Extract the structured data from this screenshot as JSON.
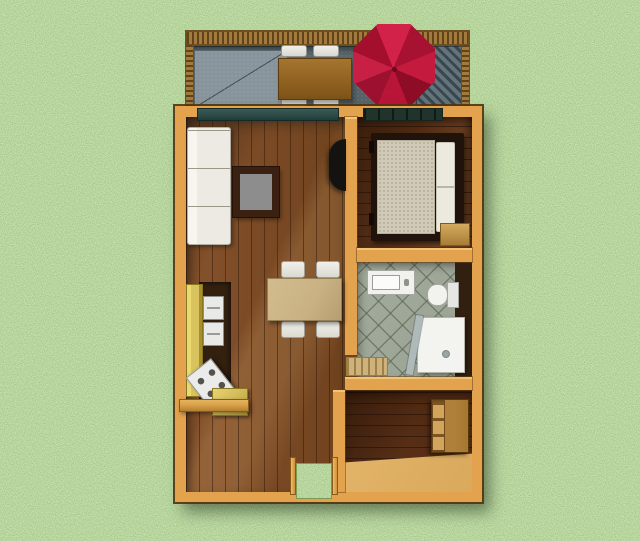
{
  "scene": {
    "type": "3d-floor-plan-render",
    "view": "top-down",
    "width_px": 640,
    "height_px": 541
  },
  "colors": {
    "grass": "#78a95e",
    "wall": "#e2a24e",
    "wall-highlight": "#f4c475",
    "wall-edge": "#7a5014",
    "living-floor": "#7b4a27",
    "bedroom-floor": "#5a3018",
    "deck-floor": "#5d6b70",
    "deck-pad": "#87949b",
    "awning-dark": "#39474e",
    "railing": "#8a6526",
    "umbrella-red": "#c01534",
    "umbrella-red-dark": "#8f0c26",
    "tile": "#9aa294",
    "tile-grout": "#78816f",
    "furniture-white": "#eceae3",
    "patio-table-wood": "#99662a",
    "dining-table": "#c9b183",
    "cabinet-yellow": "#d8c35e",
    "counter-dark": "#33200f",
    "shelf-wood": "#d8a24a",
    "mattress": "#d0cab7",
    "pillow": "#eceade",
    "bed-frame": "#20130c",
    "bench-wood": "#c79c50",
    "dresser-wood": "#a5772f",
    "light-floor": "#d9a95c",
    "bath-mat": "#cdb27c",
    "glass-door": "#2c4a47",
    "window-dark": "#20342c",
    "tv-black": "#151311",
    "alcove-dark": "#31200f",
    "shower": "#f3f3f0"
  },
  "inventory": {
    "deck": [
      "wood-railing",
      "stone-floor",
      "light-pad",
      "slatted-awning",
      "patio-table",
      "patio-chair x4",
      "red-umbrella"
    ],
    "living_room": [
      "white-sofa",
      "coffee-table",
      "wall-tv",
      "dining-table",
      "dining-chair x4",
      "glass-door-to-deck"
    ],
    "kitchen": [
      "tall-yellow-cabinet",
      "built-in-appliances",
      "stove",
      "counter-island",
      "wall-shelf"
    ],
    "bedroom": [
      "window",
      "double-bed",
      "mattress",
      "pillows",
      "foot-bench"
    ],
    "bathroom": [
      "vanity-sink",
      "toilet",
      "corner-shower",
      "bath-mat",
      "dark-alcove"
    ],
    "back_room": [
      "dresser",
      "light-floor-area"
    ],
    "entry": [
      "open-door-grass-mat",
      "door-posts"
    ]
  }
}
